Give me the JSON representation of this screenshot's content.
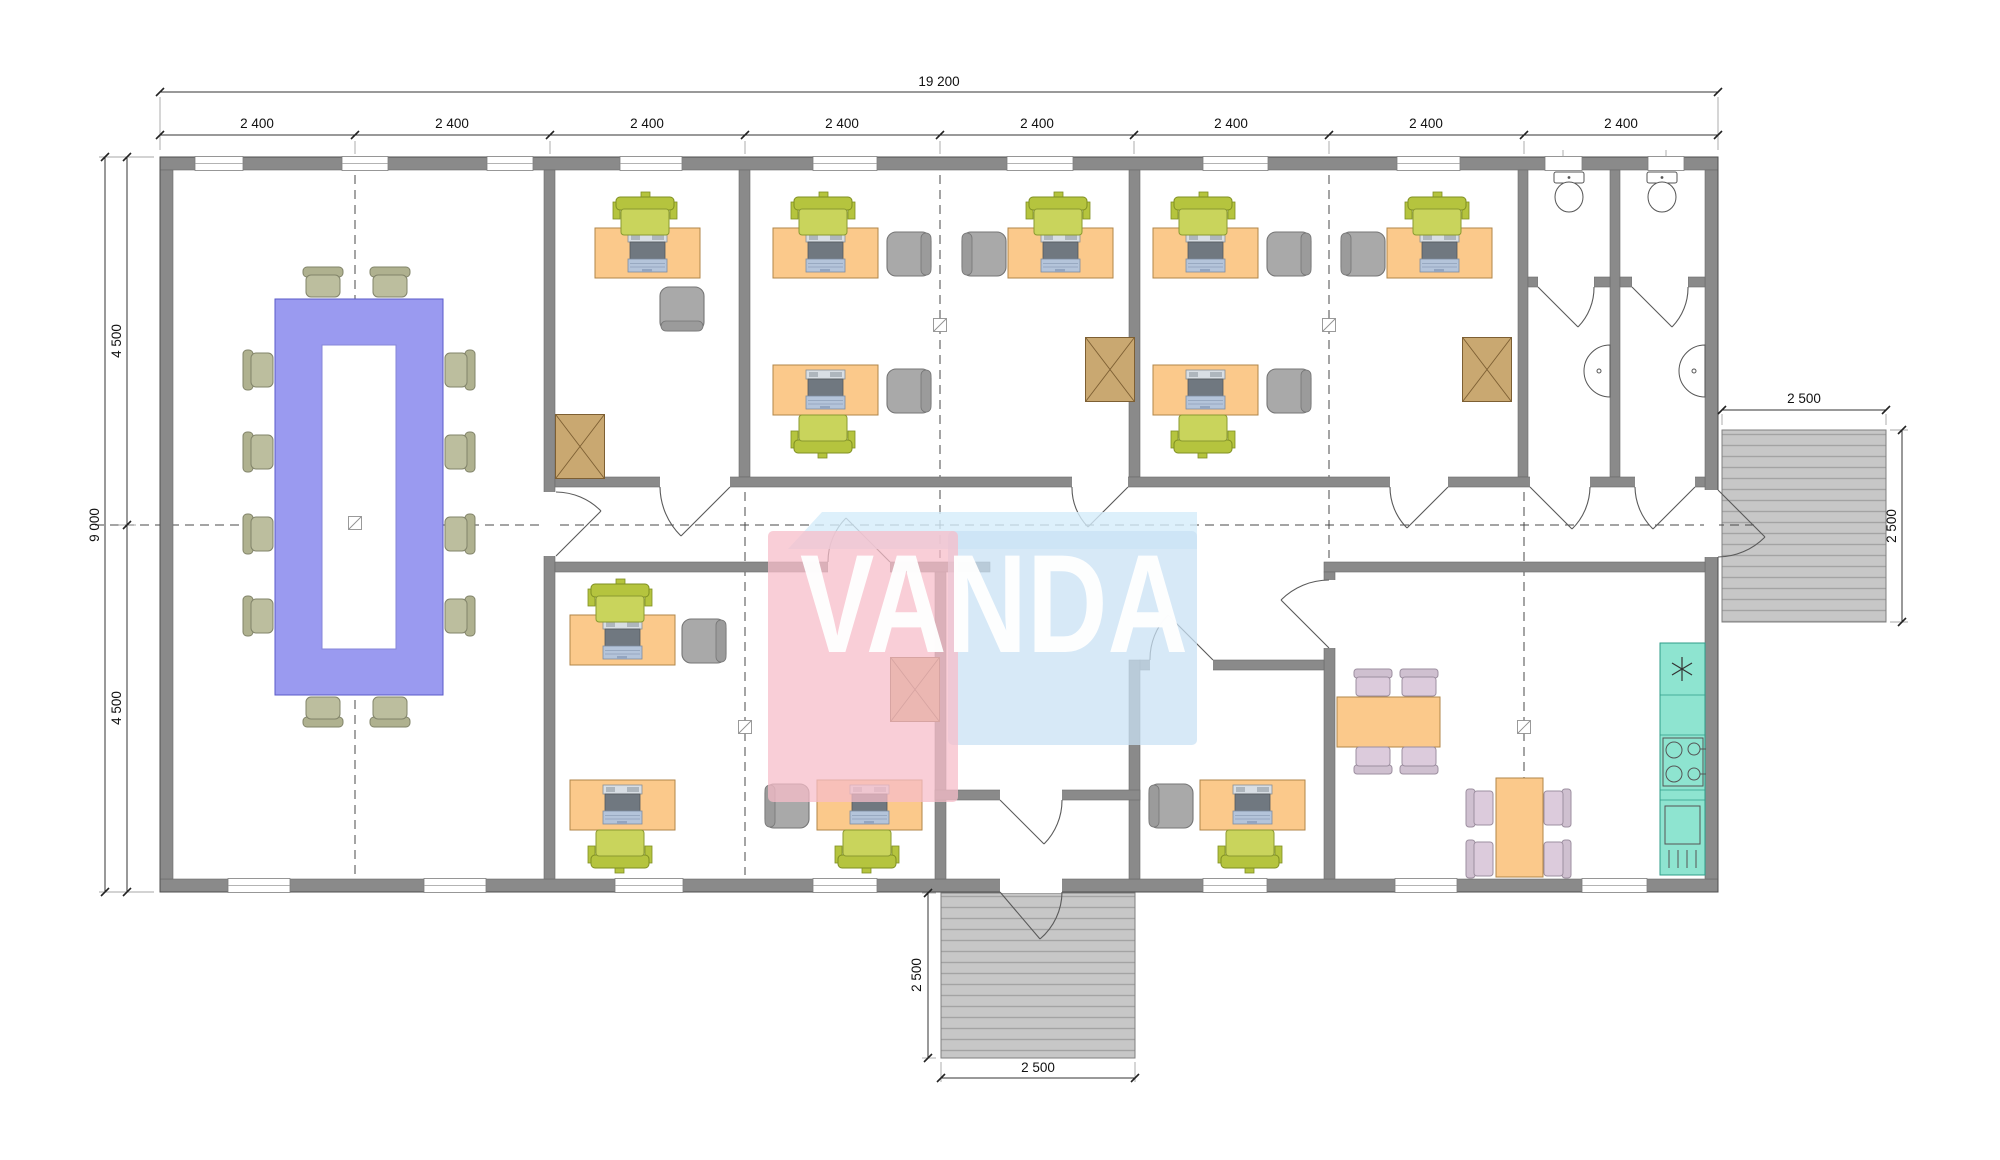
{
  "logo": {
    "text": "VANDA"
  },
  "dimensions": {
    "overall_width": "19 200",
    "bays": [
      "2 400",
      "2 400",
      "2 400",
      "2 400",
      "2 400",
      "2 400",
      "2 400",
      "2 400"
    ],
    "overall_height": "9 000",
    "height_upper": "4 500",
    "height_lower": "4 500",
    "right_stair_width": "2 500",
    "right_stair_height": "2 500",
    "bottom_stair_height": "2 500",
    "bottom_stair_width": "2 500"
  },
  "colors": {
    "wall": "#8a8a8a",
    "desk": "#fbc98b",
    "task_chair": "#c9d45c",
    "guest_chair": "#a9a9a9",
    "conference_table": "#9a9af0",
    "conference_chair": "#bcbe9e",
    "dining_chair": "#dccbdc",
    "kitchen_counter": "#8ee4d0",
    "storage_crate": "#c9a871",
    "stair_platform": "#c7c7c7",
    "logo_pink": "#f7bdc9",
    "logo_blue": "#c9e1f4"
  }
}
